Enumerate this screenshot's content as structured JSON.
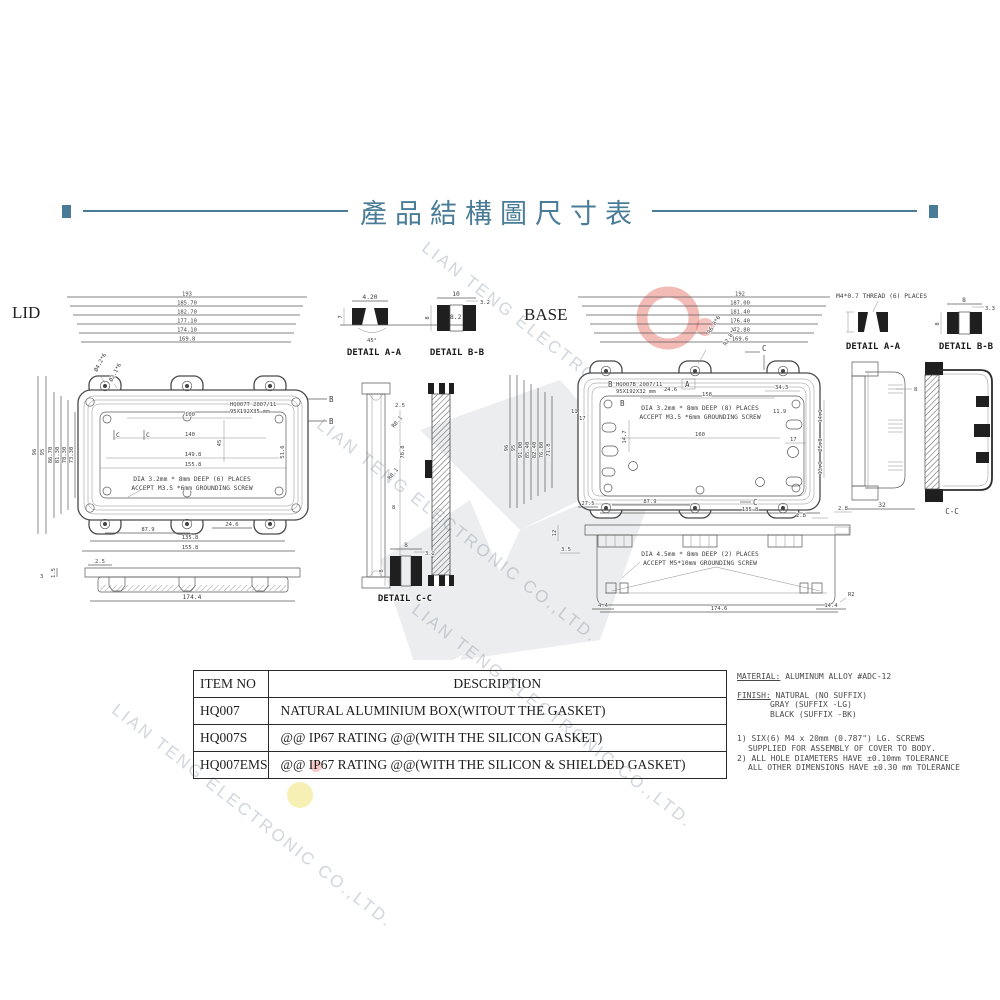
{
  "title": "產品結構圖尺寸表",
  "watermark": {
    "text": "LIAN TENG ELECTRONIC CO.,LTD."
  },
  "lid": {
    "label": "LID",
    "top_dims": [
      "193",
      "185.70",
      "182.70",
      "177.10",
      "174.10",
      "169.8"
    ],
    "left_dims": [
      "96",
      "95",
      "86.70",
      "81.30",
      "78.30",
      "73.30"
    ],
    "hole_labels": [
      "Ø4.2*6",
      "Ø2.1*6"
    ],
    "plate_text": [
      "HQ007T 2007/11",
      "95X192X35 mm"
    ],
    "inner_dims": [
      "100",
      "140",
      "45",
      "149.8",
      "155.8",
      "51.6"
    ],
    "note": [
      "DIA 3.2mm * 8mm DEEP (6) PLACES",
      "ACCEPT M3.5 *6mm GROUNDING SCREW"
    ],
    "bottom_dims": [
      "87.9",
      "24.6",
      "135.8",
      "155.8"
    ],
    "side_dims": [
      "1.5",
      "3",
      "2.5",
      "174.4"
    ],
    "markers": {
      "b": "B",
      "c": "C"
    }
  },
  "details_left": {
    "aa": {
      "label": "DETAIL A-A",
      "dims": [
        "4.20",
        "8.2",
        "7"
      ],
      "note": "45°"
    },
    "bb": {
      "label": "DETAIL B-B",
      "dims": [
        "10",
        "3.2",
        "8"
      ]
    },
    "section_dims": [
      "2.5",
      "78.8",
      "R0.1",
      "R0.1",
      "8"
    ],
    "cc": {
      "label": "DETAIL C-C",
      "dims": [
        "8",
        "3.2",
        "8"
      ]
    }
  },
  "base": {
    "label": "BASE",
    "top_dims": [
      "192",
      "187.00",
      "181.40",
      "176.40",
      "172.80",
      "169.6"
    ],
    "left_dims": [
      "96",
      "95",
      "91.00",
      "85.40",
      "82.40",
      "76.80",
      "71.8"
    ],
    "hole_labels": [
      "R6.8*6",
      "R2.8*6"
    ],
    "plate_text": [
      "HQ007B 2007/11",
      "95X192X32 mm"
    ],
    "plate_dims": [
      "24.6",
      "158",
      "34.3"
    ],
    "note": [
      "DIA 3.2mm * 8mm DEEP (8) PLACES",
      "ACCEPT M3.5 *6mm GROUNDING SCREW"
    ],
    "inner_dims": [
      "11",
      "17",
      "14.7",
      "160",
      "11.9",
      "17"
    ],
    "right_dims": [
      "14.1",
      "25.8",
      "13.1"
    ],
    "mid_dims": [
      "27.5",
      "87.9",
      "135.8",
      "2.8",
      "2.8"
    ],
    "markers": {
      "a": "A",
      "b": "B",
      "c": "C"
    },
    "side": {
      "note": [
        "DIA 4.5mm * 8mm DEEP (2) PLACES",
        "ACCEPT M5*10mm GROUNDING SCREW"
      ],
      "dims": [
        "3.5",
        "12",
        "4.4",
        "174.6",
        "14.4",
        "R2"
      ]
    }
  },
  "right_col": {
    "thread_note": "M4*0.7 THREAD (6) PLACES",
    "aa_label": "DETAIL A-A",
    "bb_label": "DETAIL B-B",
    "bb_dims": [
      "8",
      "3.3",
      "8"
    ],
    "section_dims": [
      "8",
      "32"
    ],
    "cc_label": "C-C"
  },
  "table": {
    "headers": [
      "ITEM NO",
      "DESCRIPTION"
    ],
    "rows": [
      {
        "item": "HQ007",
        "desc": "NATURAL ALUMINIUM BOX(WITOUT THE GASKET)"
      },
      {
        "item": "HQ007S",
        "desc": "@@ IP67 RATING @@(WITH THE SILICON GASKET)"
      },
      {
        "item": "HQ007EMS",
        "desc": "@@ IP67 RATING @@(WITH THE  SILICON & SHIELDED GASKET)"
      }
    ]
  },
  "notes": {
    "material_label": "MATERIAL:",
    "material_value": "ALUMINUM ALLOY #ADC-12",
    "finish_label": "FINISH:",
    "finish_value": "NATURAL (NO SUFFIX)",
    "finish_opt1": "GRAY (SUFFIX -LG)",
    "finish_opt2": "BLACK (SUFFIX -BK)",
    "note1a": "1) SIX(6) M4 x 20mm (0.787\") LG. SCREWS",
    "note1b": "SUPPLIED FOR ASSEMBLY OF COVER TO BODY.",
    "note2a": "2) ALL HOLE DIAMETERS HAVE ±0.10mm TOLERANCE",
    "note2b": "ALL OTHER DIMENSIONS HAVE ±0.30 mm TOLERANCE"
  },
  "colors": {
    "accent": "#4a7c98",
    "line": "#5a5a5a",
    "red_logo": "#e2564a",
    "yellow_logo": "#f0e26a",
    "watermark": "#c6cdd4"
  }
}
